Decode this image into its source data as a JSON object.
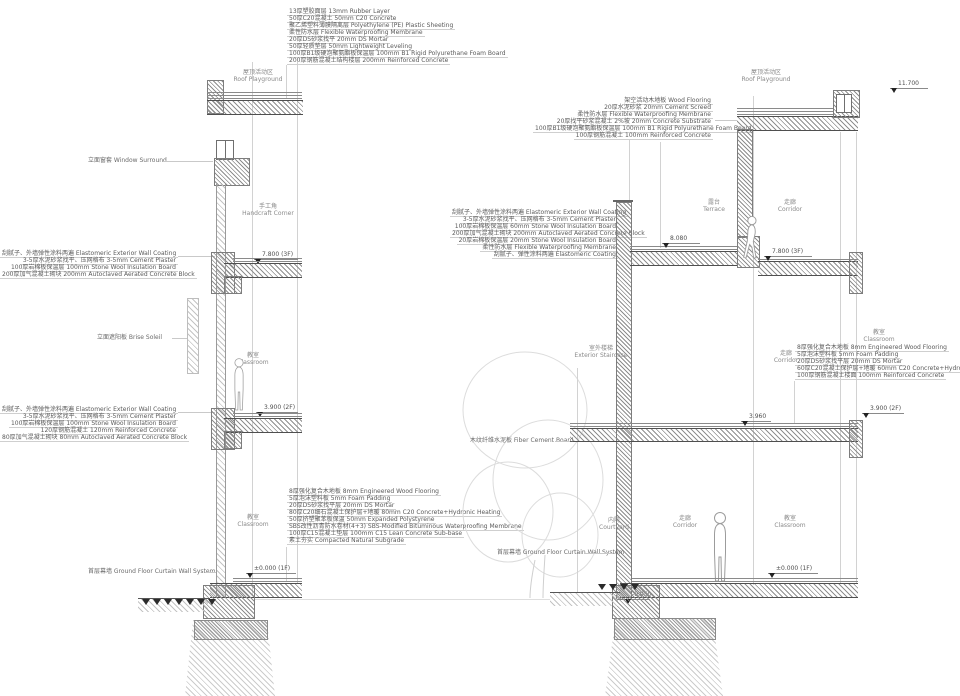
{
  "palette": {
    "background": "#ffffff",
    "linework": "#777777",
    "light_line": "#cccccc",
    "label_text": "#555555",
    "hatch": "#999999",
    "marker": "#222222"
  },
  "rooms": {
    "roof": {
      "zh": "屋顶活动区",
      "en": "Roof Playground"
    },
    "handcraft": {
      "zh": "手工角",
      "en": "Handcraft Corner"
    },
    "classroom": {
      "zh": "教室",
      "en": "Classroom"
    },
    "terrace": {
      "zh": "露台",
      "en": "Terrace"
    },
    "corridor": {
      "zh": "走廊",
      "en": "Corridor"
    },
    "stair": {
      "zh": "室外楼梯",
      "en": "Exterior Staircase"
    },
    "courtyard": {
      "zh": "内院",
      "en": "Courtyard"
    }
  },
  "callouts": {
    "window_surround": "立面窗套 Window Surround",
    "brise_soleil": "立面遮阳板 Brise Soleil",
    "fiber_cement": "木纹纤维水泥板 Fiber Cement Board",
    "curtain_left": "首层幕墙 Ground Floor Curtain Wall System",
    "curtain_right": "首层幕墙 Ground Floor Curtain Wall System"
  },
  "stacks": {
    "roof_left_buildup": [
      "13厚塑胶面层 13mm Rubber Layer",
      "50厚C20混凝土 50mm C20 Concrete",
      "聚乙烯塑料薄膜隔离层 Polyethylene (PE) Plastic Sheeting",
      "柔性防水层 Flexible Waterproofing Membrane",
      "20厚DS砂浆找平 20mm DS Mortar",
      "50厚轻质垫层 50mm Lightweight Leveling",
      "100厚B1级硬泡聚氨酯板保温层 100mm B1 Rigid Polyurethane Foam Board",
      "200厚钢筋混凝土结构楼层 200mm Reinforced Concrete"
    ],
    "wall_upper_left": [
      "刮腻子、外墙弹性涂料两遍 Elastomeric Exterior Wall Coating",
      "3-5厚水泥砂浆找平、压网格布 3-5mm Cement Plaster",
      "100厚岩棉板保温层 100mm Stone Wool Insulation Board",
      "200厚加气混凝土砌块 200mm Autoclaved Aerated Concrete Block"
    ],
    "wall_lower_left": [
      "刮腻子、外墙弹性涂料两遍 Elastomeric Exterior Wall Coating",
      "3-5厚水泥砂浆找平、压网格布 3-5mm Cement Plaster",
      "100厚岩棉板保温层 100mm Stone Wool Insulation Board",
      "120厚钢筋混凝土 120mm Reinforced Concrete",
      "80厚加气混凝土砌块 80mm Autoclaved Aerated Concrete Block"
    ],
    "ground_floor_buildup": [
      "8厚强化复合木地板 8mm Engineered Wood Flooring",
      "5厚泡沫塑料板 5mm Foam Padding",
      "20厚DS砂浆找平层 20mm DS Mortar",
      "80厚C20细石混凝土保护层+地暖 80mm C20 Concrete+Hydronic Heating",
      "50厚挤塑聚苯板保温 50mm Expanded Polystyrene",
      "SBS改性沥青防水卷材(4+3) SBS-Modified Bituminous Waterproofing Membrane",
      "100厚C15混凝土垫层 100mm C15 Lean Concrete Sub-base",
      "素土夯实 Compacted Natural Subgrade"
    ],
    "roof_right_buildup": [
      "架空活动木地板 Wood Flooring",
      "20厚水泥砂浆 20mm Cement Screed",
      "柔性防水层 Flexible Waterproofing Membrane",
      "20厚找平砂浆混凝土 2%坡 20mm Concrete Substrate",
      "100厚B1级硬泡聚氨酯板保温层 100mm B1 Rigid Polyurethane Foam Board",
      "100厚钢筋混凝土 100mm Reinforced Concrete"
    ],
    "terrace_wall": [
      "刮腻子、外墙弹性涂料两遍 Elastomeric Exterior Wall Coating",
      "3-5厚水泥砂浆找平、压网格布 3-5mm Cement Plaster",
      "100厚岩棉板保温层 60mm Stone Wool Insulation Board",
      "200厚加气混凝土砌块 200mm Autoclaved Aerated Concrete Block",
      "20厚岩棉板保温层 20mm Stone Wool Insulation Board",
      "柔性防水层 Flexible Waterproofing Membrane",
      "刮腻子、弹性涂料两遍 Elastomeric Coating"
    ],
    "floor_2f_buildup": [
      "8厚强化复合木地板 8mm Engineered Wood Flooring",
      "5厚泡沫塑料板 5mm Foam Padding",
      "20厚DS砂浆找平层 20mm DS Mortar",
      "60厚C20混凝土保护层+地暖 60mm C20 Concrete+Hydronic Heating",
      "100厚钢筋混凝土楼面 100mm Reinforced Concrete"
    ]
  },
  "elevations": {
    "roof_right": "11.700",
    "left_3f": "7.800 (3F)",
    "left_2f": "3.900 (2F)",
    "left_gf": "±0.000 (1F)",
    "terrace": "8.080",
    "right_3f": "7.800 (3F)",
    "right_2f_inner": "3.960",
    "right_2f": "3.900 (2F)",
    "right_gf": "±0.000 (1F)",
    "courtyard": "-0.050"
  }
}
